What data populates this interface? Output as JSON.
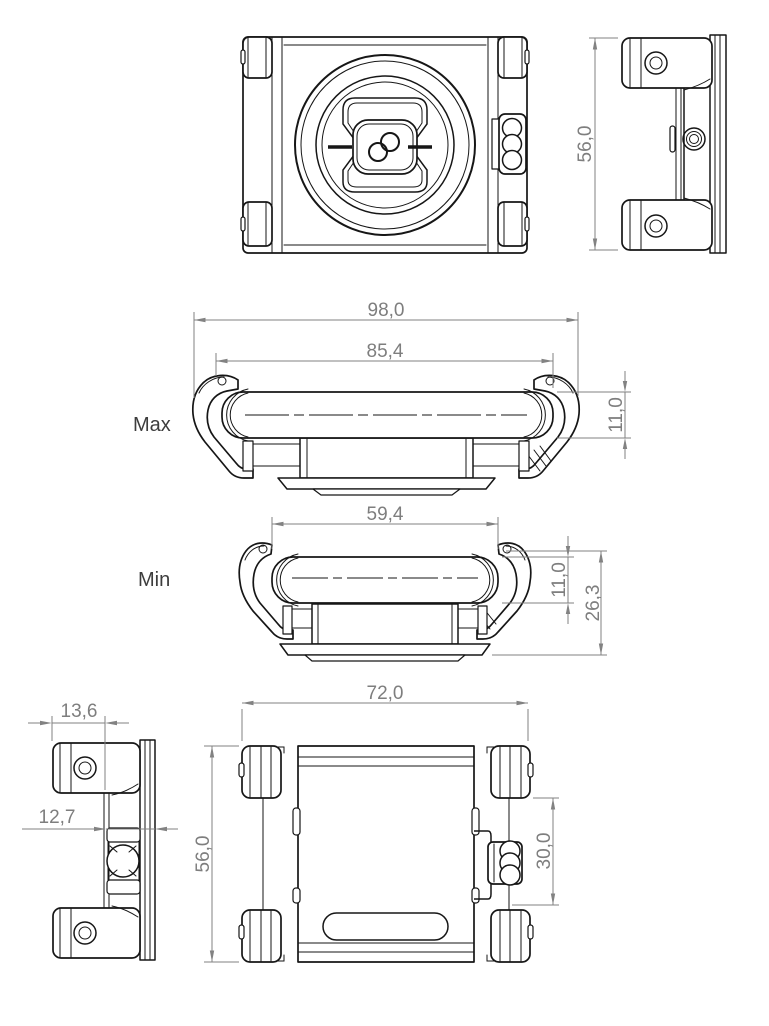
{
  "drawing": {
    "labels": {
      "max": "Max",
      "min": "Min"
    },
    "dimensions": {
      "side_height_top": "56,0",
      "max_overall_width": "98,0",
      "max_opening_width": "85,4",
      "max_cradle_height": "11,0",
      "min_opening_width": "59,4",
      "min_cradle_height": "11,0",
      "min_overall_height": "26,3",
      "arm_block_width": "13,6",
      "mount_depth": "12,7",
      "back_width": "72,0",
      "back_height": "56,0",
      "knob_cutout_height": "30,0"
    },
    "colors": {
      "part_line": "#161616",
      "dimension": "#828282",
      "background": "#ffffff"
    }
  }
}
